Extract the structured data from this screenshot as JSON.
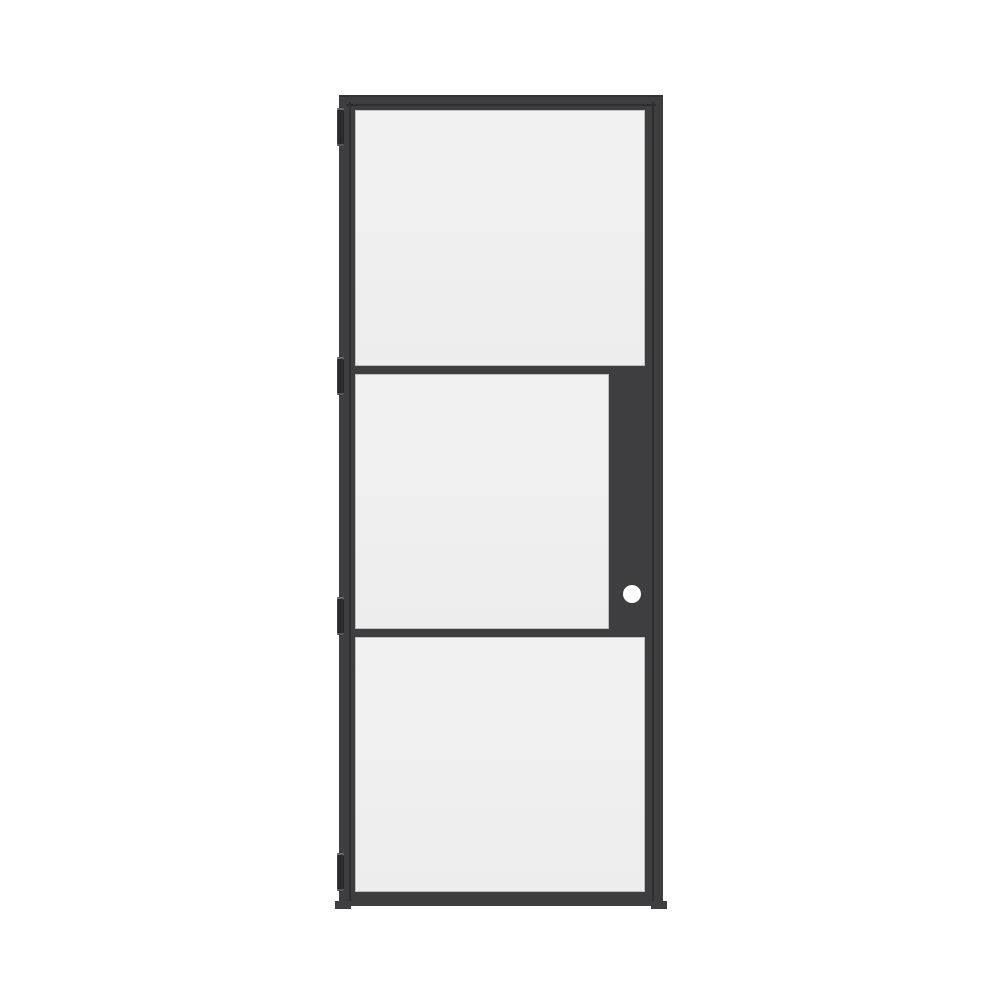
{
  "page": {
    "background": "#ffffff",
    "description": "Product render of a black steel-frame interior door with three glass lites on a plain white background"
  },
  "door": {
    "name": "3-lite black steel frame glass door, left-hinged",
    "colors": {
      "background": "#ffffff",
      "frame": "#3e3e40",
      "gap": "#2c2c2e",
      "hinge": "#2a2a2c",
      "knob": "#ffffff",
      "glass": "#f0f0f1"
    },
    "panels": [
      {
        "label": "top glass panel"
      },
      {
        "label": "middle glass panel (shortened by lock stile)"
      },
      {
        "label": "bottom glass panel"
      }
    ],
    "hinges": {
      "count": 4,
      "side": "left"
    },
    "hardware": {
      "type": "round knob bore hole",
      "side": "right",
      "location": "middle lock stile"
    }
  }
}
